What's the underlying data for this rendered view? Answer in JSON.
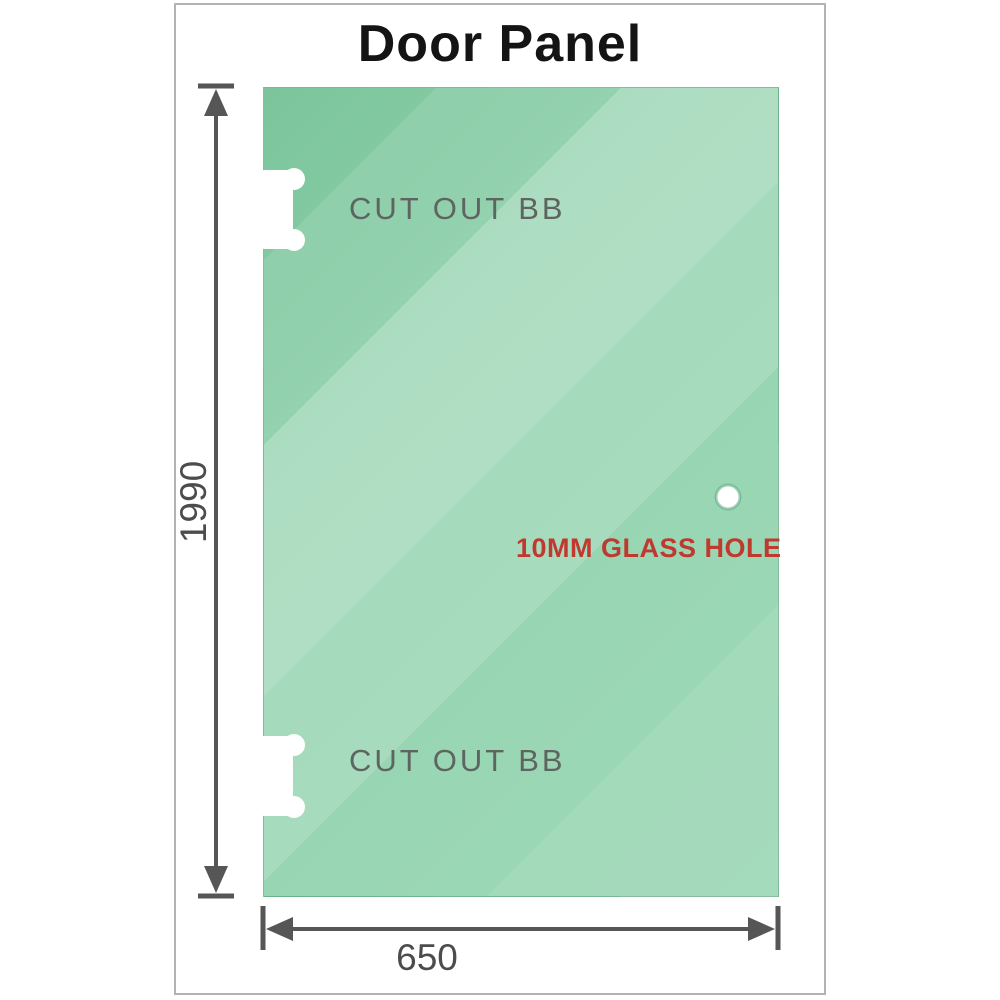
{
  "diagram": {
    "title": "Door Panel",
    "panel": {
      "height_label": "1990",
      "width_label": "650",
      "cutout_top_label": "CUT OUT BB",
      "cutout_bottom_label": "CUT OUT BB",
      "hole_label": "10MM GLASS HOLE"
    },
    "colors": {
      "glass_green_dark": "#7cc59c",
      "glass_green_light": "#c6ead5",
      "hole_label_red": "#c0392f",
      "cutout_label_gray": "#5e6561",
      "dimension_gray": "#565656",
      "frame_border_gray": "#b3b3b3",
      "title_black": "#141414"
    }
  }
}
